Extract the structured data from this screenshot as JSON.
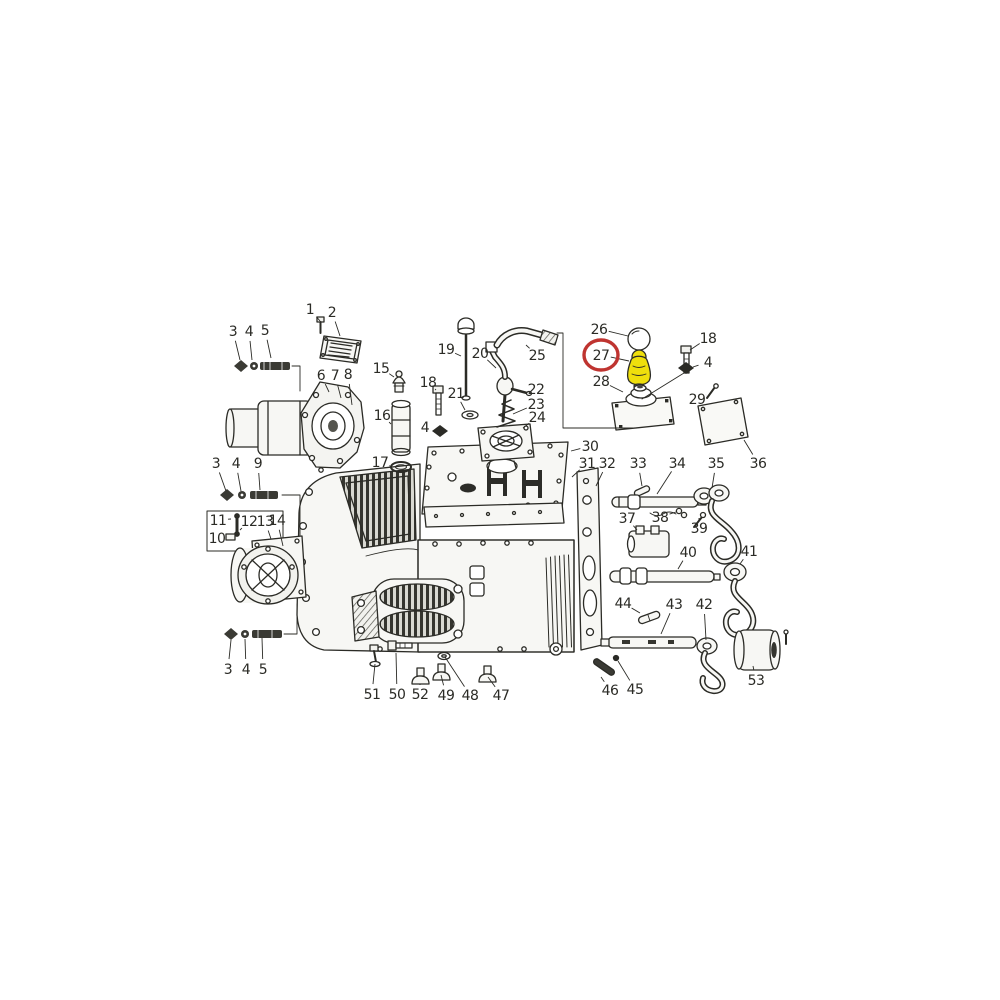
{
  "image": {
    "width": 1000,
    "height": 1000,
    "kind": "exploded-parts-diagram",
    "subject": "gearbox / transmission assembly line drawing with numbered parts"
  },
  "colors": {
    "background": "#ffffff",
    "ink": "#2b2b26",
    "paper": "#f7f7f4",
    "highlight_ring": "#bf3430",
    "highlight_fill": "#efdf0c",
    "label": "#2b2b26"
  },
  "highlight": {
    "part_number": "27",
    "ring": {
      "cx": 601,
      "cy": 355,
      "rx": 17,
      "ry": 15
    }
  },
  "callouts": [
    {
      "id": "1",
      "n": "1",
      "lx": 310,
      "ly": 309,
      "tx": 320,
      "ty": 321
    },
    {
      "id": "2",
      "n": "2",
      "lx": 332,
      "ly": 312,
      "tx": 340,
      "ty": 336
    },
    {
      "id": "3a",
      "n": "3",
      "lx": 233,
      "ly": 331,
      "tx": 240,
      "ty": 360
    },
    {
      "id": "4a",
      "n": "4",
      "lx": 249,
      "ly": 331,
      "tx": 252,
      "ty": 360
    },
    {
      "id": "5a",
      "n": "5",
      "lx": 265,
      "ly": 330,
      "tx": 271,
      "ty": 358
    },
    {
      "id": "6",
      "n": "6",
      "lx": 321,
      "ly": 375,
      "tx": 329,
      "ty": 392
    },
    {
      "id": "7",
      "n": "7",
      "lx": 335,
      "ly": 375,
      "tx": 341,
      "ty": 398
    },
    {
      "id": "8",
      "n": "8",
      "lx": 348,
      "ly": 374,
      "tx": 352,
      "ty": 405
    },
    {
      "id": "15",
      "n": "15",
      "lx": 381,
      "ly": 368,
      "tx": 394,
      "ty": 377
    },
    {
      "id": "16",
      "n": "16",
      "lx": 382,
      "ly": 415,
      "tx": 391,
      "ty": 424
    },
    {
      "id": "17",
      "n": "17",
      "lx": 380,
      "ly": 462,
      "tx": 390,
      "ty": 466
    },
    {
      "id": "18a",
      "n": "18",
      "lx": 428,
      "ly": 382,
      "tx": 436,
      "ty": 390
    },
    {
      "id": "4c",
      "n": "4",
      "lx": 425,
      "ly": 427,
      "tx": 433,
      "ty": 431
    },
    {
      "id": "19",
      "n": "19",
      "lx": 446,
      "ly": 349,
      "tx": 461,
      "ty": 356
    },
    {
      "id": "21",
      "n": "21",
      "lx": 456,
      "ly": 393,
      "tx": 465,
      "ty": 410
    },
    {
      "id": "20",
      "n": "20",
      "lx": 480,
      "ly": 353,
      "tx": 496,
      "ty": 368
    },
    {
      "id": "25",
      "n": "25",
      "lx": 537,
      "ly": 355,
      "tx": 526,
      "ty": 345
    },
    {
      "id": "22",
      "n": "22",
      "lx": 536,
      "ly": 389,
      "tx": 528,
      "ty": 392
    },
    {
      "id": "23",
      "n": "23",
      "lx": 536,
      "ly": 404,
      "tx": 513,
      "ty": 414
    },
    {
      "id": "24",
      "n": "24",
      "lx": 537,
      "ly": 417,
      "tx": 523,
      "ty": 428
    },
    {
      "id": "26",
      "n": "26",
      "lx": 599,
      "ly": 329,
      "tx": 628,
      "ty": 336
    },
    {
      "id": "27",
      "n": "27",
      "lx": 601,
      "ly": 355,
      "tx": 629,
      "ty": 361
    },
    {
      "id": "28",
      "n": "28",
      "lx": 601,
      "ly": 381,
      "tx": 623,
      "ty": 392
    },
    {
      "id": "18b",
      "n": "18",
      "lx": 708,
      "ly": 338,
      "tx": 690,
      "ty": 350
    },
    {
      "id": "4b",
      "n": "4",
      "lx": 708,
      "ly": 362,
      "tx": 693,
      "ty": 367
    },
    {
      "id": "29",
      "n": "29",
      "lx": 697,
      "ly": 399,
      "tx": 706,
      "ty": 395
    },
    {
      "id": "36",
      "n": "36",
      "lx": 758,
      "ly": 463,
      "tx": 744,
      "ty": 440
    },
    {
      "id": "30",
      "n": "30",
      "lx": 590,
      "ly": 446,
      "tx": 571,
      "ty": 451
    },
    {
      "id": "31",
      "n": "31",
      "lx": 587,
      "ly": 463,
      "tx": 572,
      "ty": 477
    },
    {
      "id": "32",
      "n": "32",
      "lx": 607,
      "ly": 463,
      "tx": 596,
      "ty": 486
    },
    {
      "id": "33",
      "n": "33",
      "lx": 638,
      "ly": 463,
      "tx": 642,
      "ty": 486
    },
    {
      "id": "34",
      "n": "34",
      "lx": 677,
      "ly": 463,
      "tx": 657,
      "ty": 494
    },
    {
      "id": "35",
      "n": "35",
      "lx": 716,
      "ly": 463,
      "tx": 712,
      "ty": 488
    },
    {
      "id": "37",
      "n": "37",
      "lx": 627,
      "ly": 518,
      "tx": 637,
      "ty": 530
    },
    {
      "id": "38",
      "n": "38",
      "lx": 660,
      "ly": 517,
      "tx": 676,
      "ty": 512
    },
    {
      "id": "39",
      "n": "39",
      "lx": 699,
      "ly": 528,
      "tx": 699,
      "ty": 521
    },
    {
      "id": "40",
      "n": "40",
      "lx": 688,
      "ly": 552,
      "tx": 678,
      "ty": 569
    },
    {
      "id": "41",
      "n": "41",
      "lx": 749,
      "ly": 551,
      "tx": 740,
      "ty": 564
    },
    {
      "id": "44",
      "n": "44",
      "lx": 623,
      "ly": 603,
      "tx": 640,
      "ty": 613
    },
    {
      "id": "43",
      "n": "43",
      "lx": 674,
      "ly": 604,
      "tx": 661,
      "ty": 634
    },
    {
      "id": "42",
      "n": "42",
      "lx": 704,
      "ly": 604,
      "tx": 706,
      "ty": 640
    },
    {
      "id": "46",
      "n": "46",
      "lx": 610,
      "ly": 690,
      "tx": 601,
      "ty": 677
    },
    {
      "id": "45",
      "n": "45",
      "lx": 635,
      "ly": 689,
      "tx": 618,
      "ty": 661
    },
    {
      "id": "53",
      "n": "53",
      "lx": 756,
      "ly": 680,
      "tx": 753,
      "ty": 666
    },
    {
      "id": "51",
      "n": "51",
      "lx": 372,
      "ly": 694,
      "tx": 375,
      "ty": 664
    },
    {
      "id": "50",
      "n": "50",
      "lx": 397,
      "ly": 694,
      "tx": 396,
      "ty": 653
    },
    {
      "id": "52",
      "n": "52",
      "lx": 420,
      "ly": 694,
      "tx": 420,
      "ty": 685
    },
    {
      "id": "49",
      "n": "49",
      "lx": 446,
      "ly": 695,
      "tx": 441,
      "ty": 675
    },
    {
      "id": "48",
      "n": "48",
      "lx": 470,
      "ly": 695,
      "tx": 445,
      "ty": 657
    },
    {
      "id": "47",
      "n": "47",
      "lx": 501,
      "ly": 695,
      "tx": 488,
      "ty": 677
    },
    {
      "id": "3b",
      "n": "3",
      "lx": 216,
      "ly": 463,
      "tx": 226,
      "ty": 491
    },
    {
      "id": "4d",
      "n": "4",
      "lx": 236,
      "ly": 463,
      "tx": 241,
      "ty": 491
    },
    {
      "id": "9",
      "n": "9",
      "lx": 258,
      "ly": 463,
      "tx": 260,
      "ty": 490
    },
    {
      "id": "11",
      "n": "11",
      "lx": 218,
      "ly": 520,
      "tx": 231,
      "ty": 519
    },
    {
      "id": "12",
      "n": "12",
      "lx": 249,
      "ly": 521,
      "tx": 240,
      "ty": 530
    },
    {
      "id": "13",
      "n": "13",
      "lx": 265,
      "ly": 521,
      "tx": 271,
      "ty": 539
    },
    {
      "id": "14",
      "n": "14",
      "lx": 277,
      "ly": 520,
      "tx": 283,
      "ty": 546
    },
    {
      "id": "10",
      "n": "10",
      "lx": 217,
      "ly": 538,
      "tx": 227,
      "ty": 537
    },
    {
      "id": "3c",
      "n": "3",
      "lx": 228,
      "ly": 669,
      "tx": 231,
      "ty": 640
    },
    {
      "id": "4e",
      "n": "4",
      "lx": 246,
      "ly": 669,
      "tx": 245,
      "ty": 639
    },
    {
      "id": "5b",
      "n": "5",
      "lx": 263,
      "ly": 669,
      "tx": 262,
      "ty": 638
    }
  ]
}
